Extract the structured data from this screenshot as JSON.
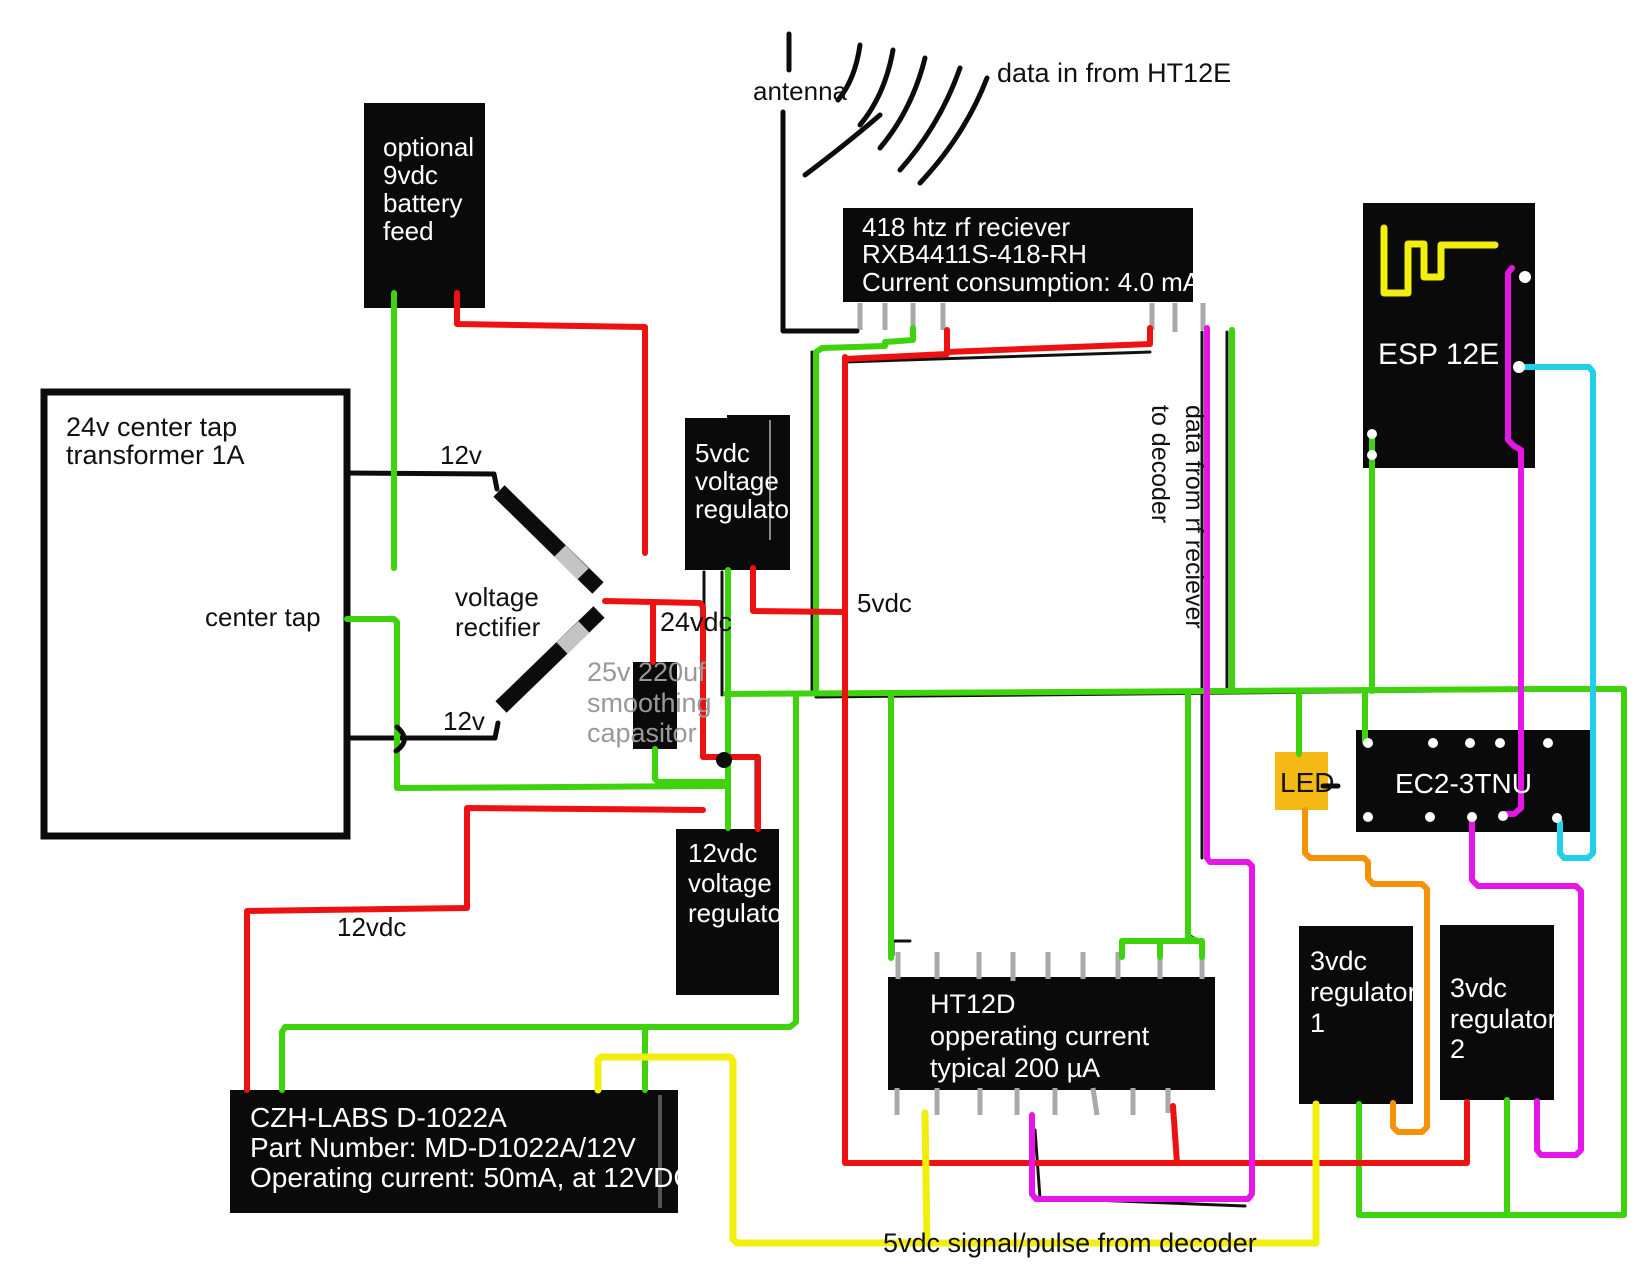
{
  "colors": {
    "wire_red": "#ee1111",
    "wire_green": "#3fd30d",
    "wire_magenta": "#e616e6",
    "wire_cyan": "#22cfe8",
    "wire_yellow": "#f2ee0e",
    "wire_orange": "#f59207",
    "led_fill": "#f5b915",
    "box_black": "#0a0a0a",
    "pin_gray": "#a9a9a9",
    "text_gray": "#999999",
    "diode_band": "#c4c4c4"
  },
  "labels": {
    "antenna": "antenna",
    "data_in": "data in from HT12E",
    "v12_top": "12v",
    "v12_bottom": "12v",
    "center_tap": "center tap",
    "rectifier_line1": "voltage",
    "rectifier_line2": "rectifier",
    "vdc24": "24vdc",
    "vdc5": "5vdc",
    "vdc12": "12vdc",
    "data_from_rf_line1": "data from rf reciever",
    "data_from_rf_line2": "to decoder",
    "pulse": "5vdc signal/pulse from decoder"
  },
  "boxes": {
    "battery": {
      "lines": [
        "optional",
        "9vdc",
        "battery",
        "feed"
      ]
    },
    "transformer": {
      "lines": [
        "24v center tap",
        "transformer 1A"
      ]
    },
    "capacitor": {
      "lines": [
        "25v 220uf",
        "smoothing",
        "capasitor"
      ]
    },
    "reg5": {
      "lines": [
        "5vdc",
        "voltage",
        "regulator"
      ]
    },
    "reg12": {
      "lines": [
        "12vdc",
        "voltage",
        "regulator"
      ]
    },
    "rf_receiver": {
      "lines": [
        "418 htz rf reciever",
        "RXB4411S-418-RH",
        "Current consumption: 4.0 mA"
      ]
    },
    "esp": {
      "label": "ESP 12E"
    },
    "relay": {
      "label": "EC2-3TNU"
    },
    "led": {
      "label": "LED"
    },
    "ht12d": {
      "lines": [
        "HT12D",
        "opperating current",
        "typical 200 µA"
      ]
    },
    "czh": {
      "lines": [
        "CZH-LABS D-1022A",
        "Part Number: MD-D1022A/12V",
        "Operating current: 50mA, at 12VDC."
      ]
    },
    "reg3_1": {
      "lines": [
        "3vdc",
        "regulator",
        "1"
      ]
    },
    "reg3_2": {
      "lines": [
        "3vdc",
        "regulator",
        "2"
      ]
    }
  }
}
